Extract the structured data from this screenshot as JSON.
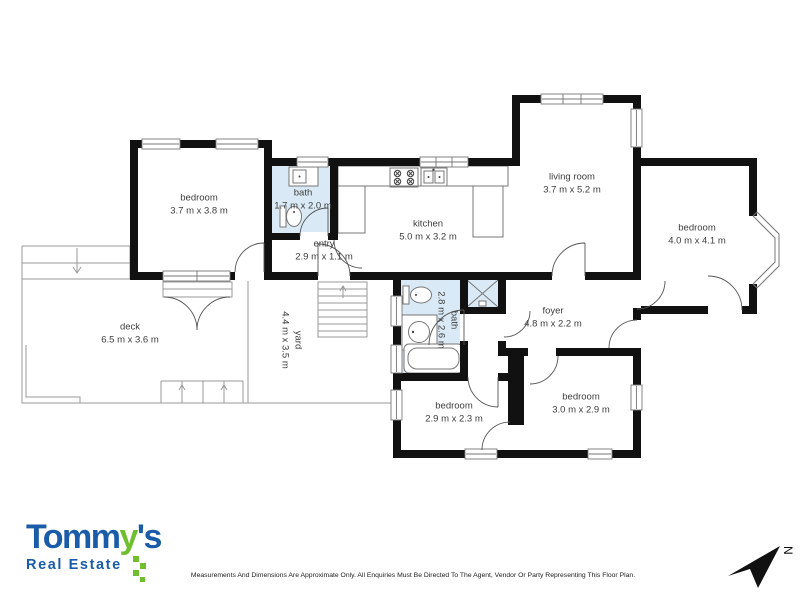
{
  "plan": {
    "rooms": [
      {
        "name": "bedroom",
        "dims": "3.7 m x 3.8 m",
        "x": 199,
        "y": 205,
        "rot": 0
      },
      {
        "name": "bath",
        "dims": "1.7 m x 2.0 m",
        "x": 303,
        "y": 200,
        "rot": 0
      },
      {
        "name": "entry",
        "dims": "2.9 m x 1.1 m",
        "x": 324,
        "y": 251,
        "rot": 0
      },
      {
        "name": "kitchen",
        "dims": "5.0 m x 3.2 m",
        "x": 428,
        "y": 231,
        "rot": 0
      },
      {
        "name": "living room",
        "dims": "3.7 m x 5.2 m",
        "x": 572,
        "y": 184,
        "rot": 0
      },
      {
        "name": "bedroom",
        "dims": "4.0 m x 4.1 m",
        "x": 697,
        "y": 235,
        "rot": 0
      },
      {
        "name": "deck",
        "dims": "6.5 m x 3.6 m",
        "x": 130,
        "y": 334,
        "rot": 0
      },
      {
        "name": "yard",
        "dims": "4.4 m x 3.5 m",
        "x": 291,
        "y": 340,
        "rot": 90
      },
      {
        "name": "bath",
        "dims": "2.8 m x 2.6 m",
        "x": 447,
        "y": 320,
        "rot": 90
      },
      {
        "name": "foyer",
        "dims": "4.8 m x 2.2 m",
        "x": 553,
        "y": 318,
        "rot": 0
      },
      {
        "name": "bedroom",
        "dims": "2.9 m x 2.3 m",
        "x": 454,
        "y": 413,
        "rot": 0
      },
      {
        "name": "bedroom",
        "dims": "3.0 m x 2.9 m",
        "x": 581,
        "y": 404,
        "rot": 0
      }
    ],
    "compass_label": "N"
  },
  "footer": {
    "brand": {
      "part1": "Tomm",
      "part2": "y",
      "part3": "'s",
      "tagline": "Real Estate"
    },
    "disclaimer": "Measurements And Dimensions Are Approximate Only. All Enquiries Must Be Directed To The Agent, Vendor Or Party Representing This Floor Plan."
  },
  "colors": {
    "wall": "#111111",
    "bathFill": "#d9eaf6",
    "line": "#999999",
    "frame": "#777777",
    "swing": "#555555",
    "labelText": "#3d3d3d",
    "logoBlue": "#1a5ca8",
    "logoGreen": "#6fbe2d"
  }
}
